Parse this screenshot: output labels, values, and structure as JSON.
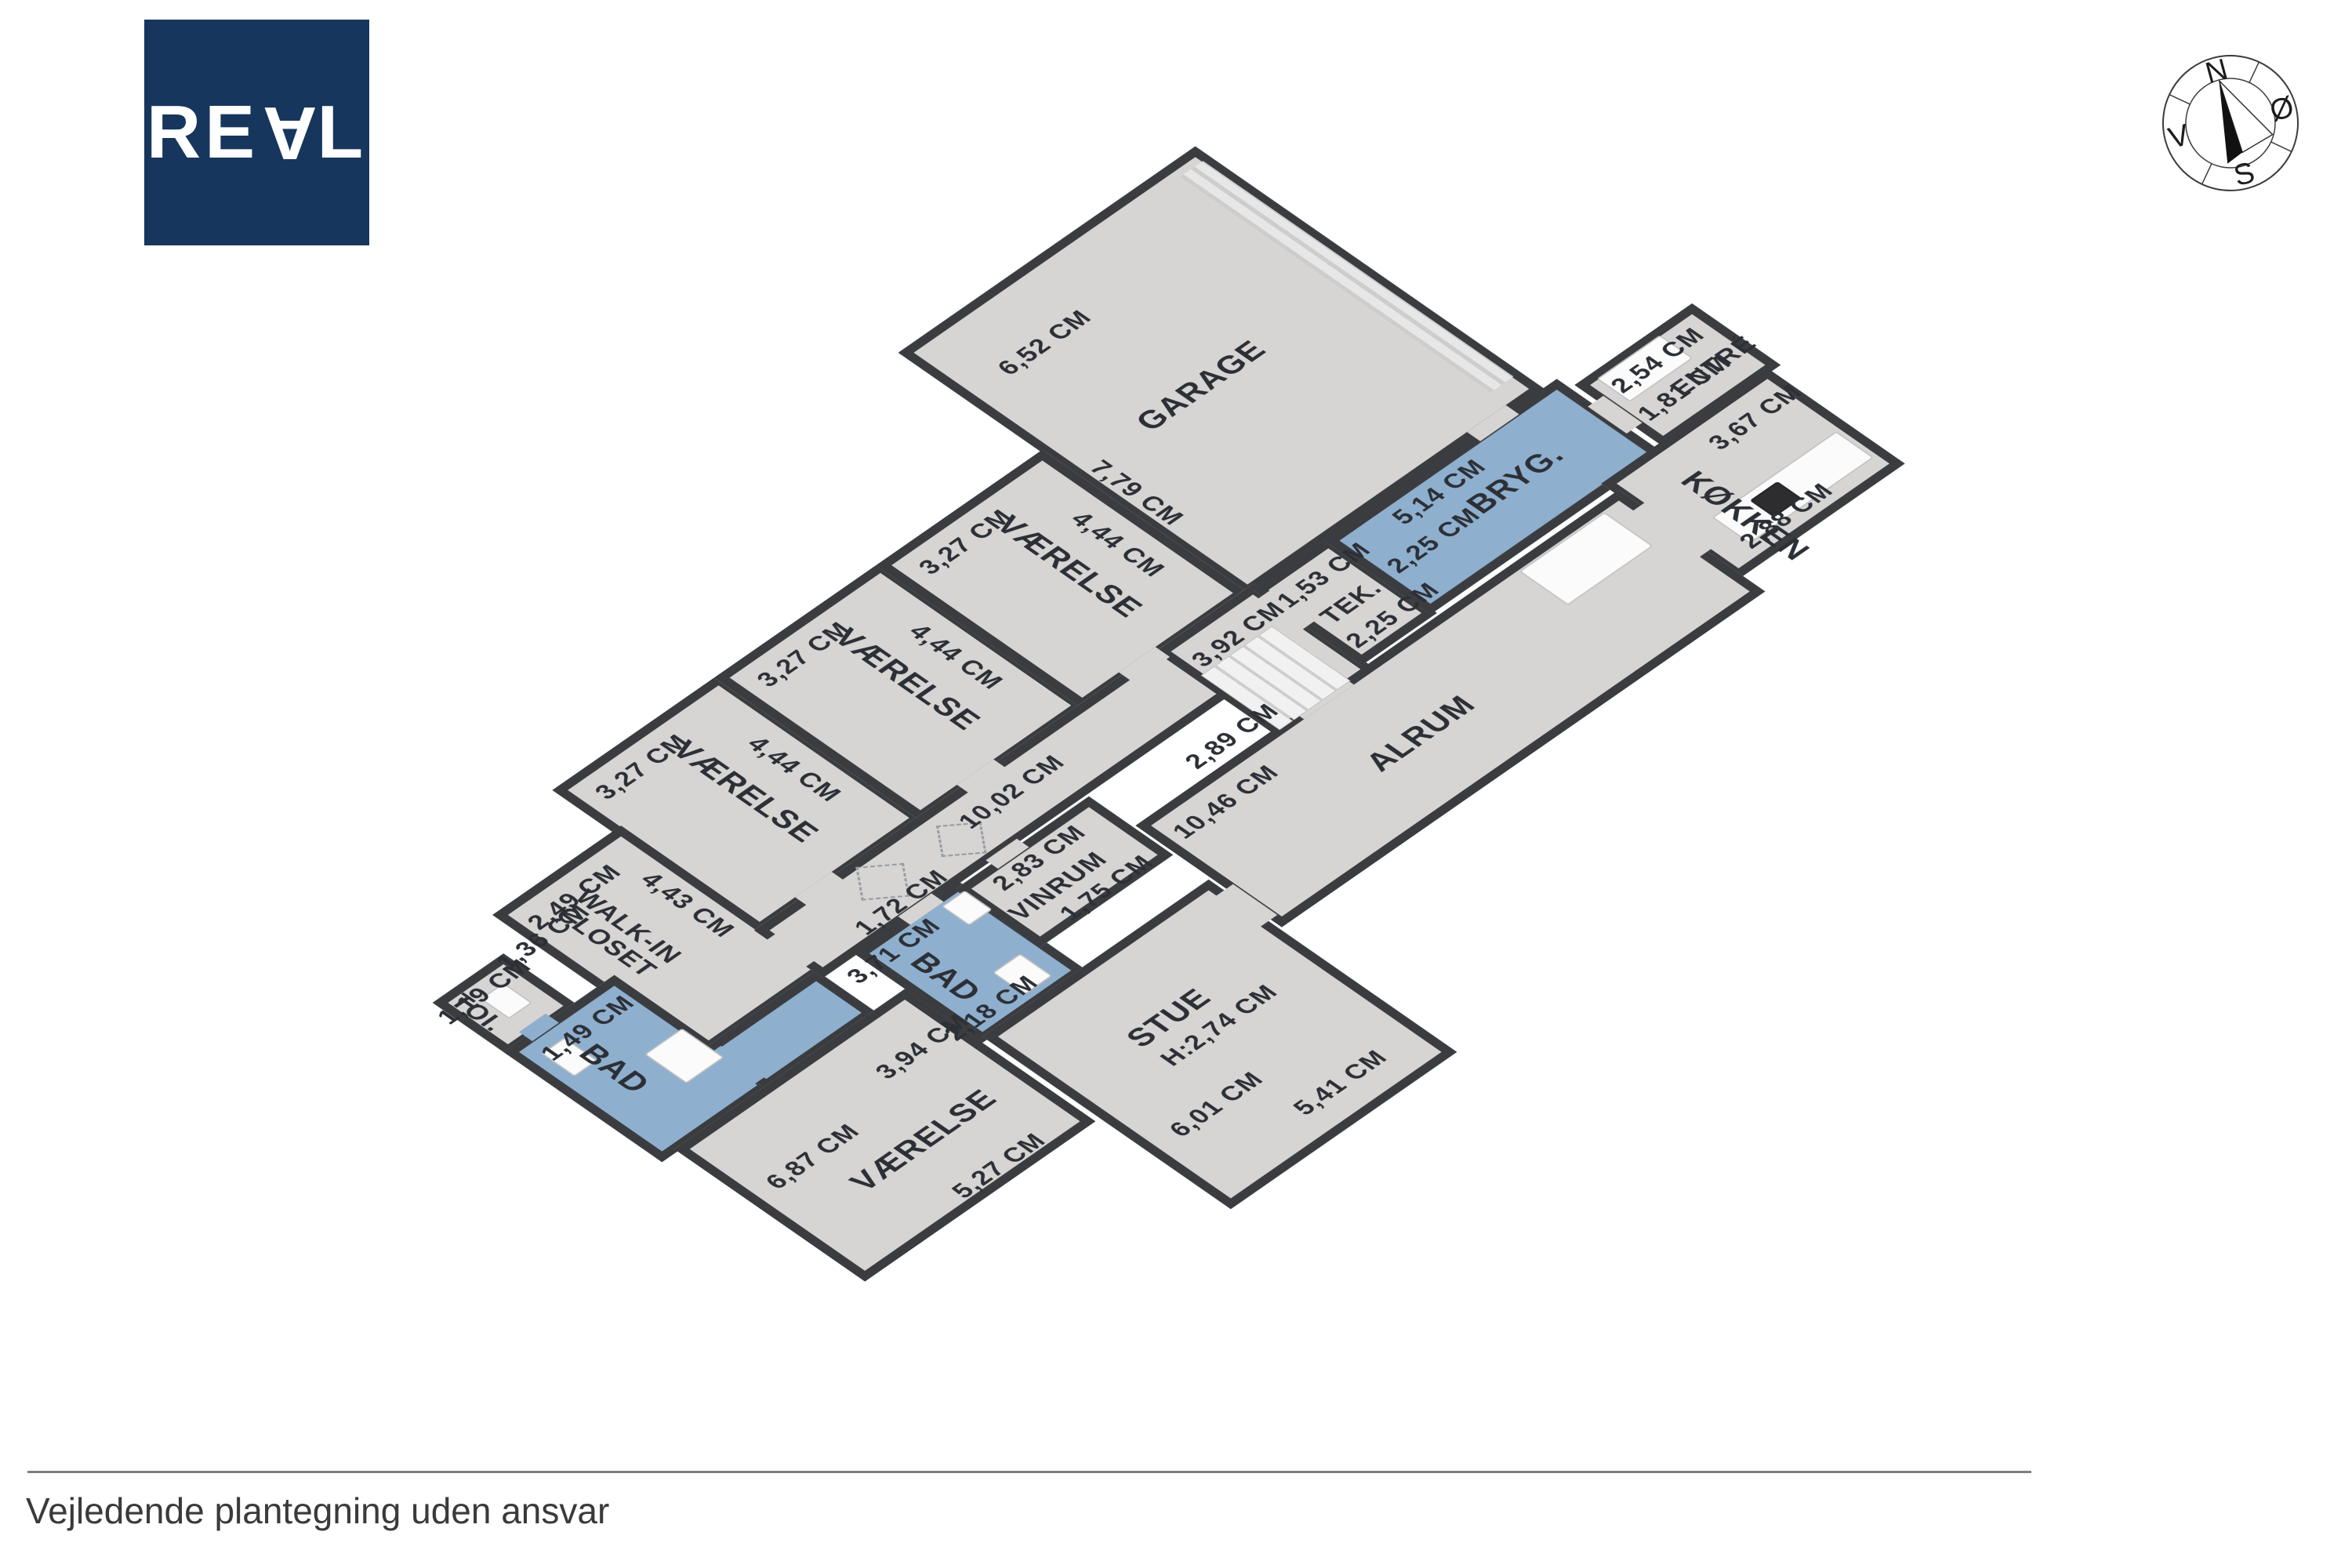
{
  "brand": {
    "letters": [
      "R",
      "E",
      "A",
      "L"
    ]
  },
  "compass": {
    "north": "N",
    "east": "Ø",
    "south": "S",
    "west": "V"
  },
  "footer": {
    "disclaimer": "Vejledende plantegning uden ansvar"
  },
  "plan": {
    "unit": "CM",
    "colors": {
      "wall": "#3a3c3f",
      "floor": "#d7d5d3",
      "wet_room": "#8fafce",
      "label": "#2c3036"
    },
    "rooms": [
      {
        "id": "garage",
        "name": "GARAGE",
        "dims": [
          "6,52 CM",
          "7,79 CM"
        ]
      },
      {
        "id": "vaerelse-1",
        "name": "VÆRELSE",
        "dims": [
          "3,27 CM",
          "4,44 CM"
        ]
      },
      {
        "id": "vaerelse-2",
        "name": "VÆRELSE",
        "dims": [
          "3,27 CM",
          "4,44 CM"
        ]
      },
      {
        "id": "vaerelse-3",
        "name": "VÆRELSE",
        "dims": [
          "3,27 CM",
          "4,44 CM"
        ]
      },
      {
        "id": "walk-in-closet",
        "name": "WALK-IN CLOSET",
        "dims": [
          "2,49 CM",
          "4,43 CM"
        ]
      },
      {
        "id": "toi",
        "name": "TOI.",
        "dims": [
          "1,19 CM",
          "1,36 CM",
          "1,49 CM"
        ]
      },
      {
        "id": "bad-vest",
        "name": "BAD",
        "dims": []
      },
      {
        "id": "vaerelse-4",
        "name": "VÆRELSE",
        "dims": [
          "6,87 CM",
          "3,94 CM",
          "5,27 CM"
        ]
      },
      {
        "id": "bad-midt",
        "name": "BAD",
        "dims": [
          "3,71 CM",
          "2,18 CM"
        ]
      },
      {
        "id": "vinrum",
        "name": "VINRUM",
        "dims": [
          "2,83 CM",
          "1,75 CM"
        ]
      },
      {
        "id": "stue",
        "name": "STUE",
        "dims": [
          "H:2,74 CM",
          "6,01 CM",
          "5,41 CM"
        ]
      },
      {
        "id": "alrum",
        "name": "ALRUM",
        "dims": [
          "10,46 CM",
          "2,89 CM",
          "3,92 CM"
        ]
      },
      {
        "id": "tek",
        "name": "TEK.",
        "dims": [
          "1,53 CM",
          "2,25 CM"
        ]
      },
      {
        "id": "bryg",
        "name": "BRYG.",
        "dims": [
          "5,14 CM",
          "2,25 CM"
        ]
      },
      {
        "id": "entre",
        "name": "ENTRÉ",
        "dims": [
          "2,54 CM",
          "1,81 CM"
        ]
      },
      {
        "id": "koekken",
        "name": "KØKKEN",
        "dims": [
          "3,67 CM",
          "2,88 CM"
        ]
      },
      {
        "id": "gang",
        "name": "",
        "dims": [
          "10,02 CM",
          "1,72 CM"
        ]
      }
    ]
  }
}
